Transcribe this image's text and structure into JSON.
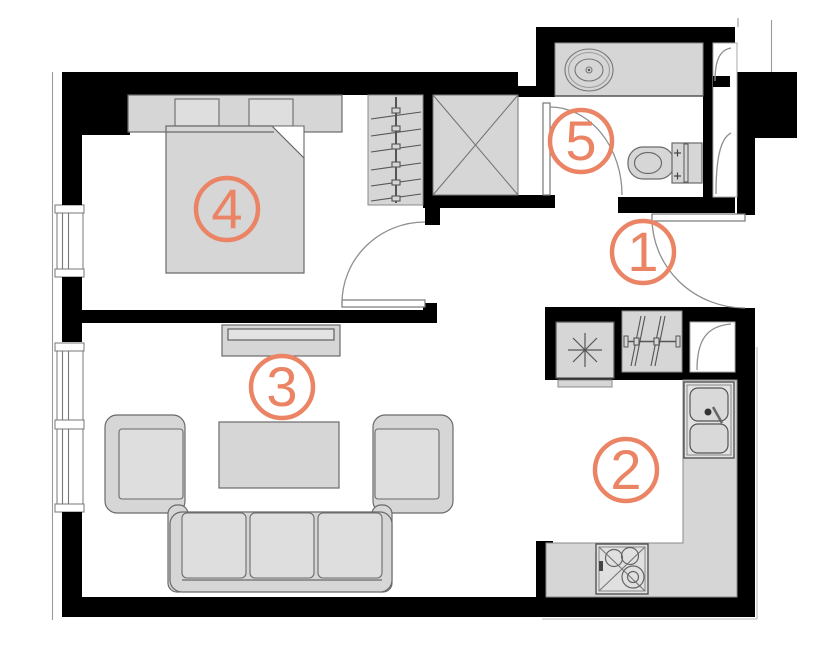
{
  "plan": {
    "title": "apartment-floor-plan",
    "colors": {
      "background": "#ffffff",
      "wall": "#000000",
      "furniture_fill": "#d6d6d6",
      "furniture_stroke": "#6a6a6a",
      "thin_line": "#9a9a9a",
      "accent": "#ea8465"
    },
    "rooms": [
      {
        "number": "1",
        "name": "hallway"
      },
      {
        "number": "2",
        "name": "kitchen"
      },
      {
        "number": "3",
        "name": "living-room"
      },
      {
        "number": "4",
        "name": "bedroom"
      },
      {
        "number": "5",
        "name": "bathroom"
      }
    ]
  }
}
